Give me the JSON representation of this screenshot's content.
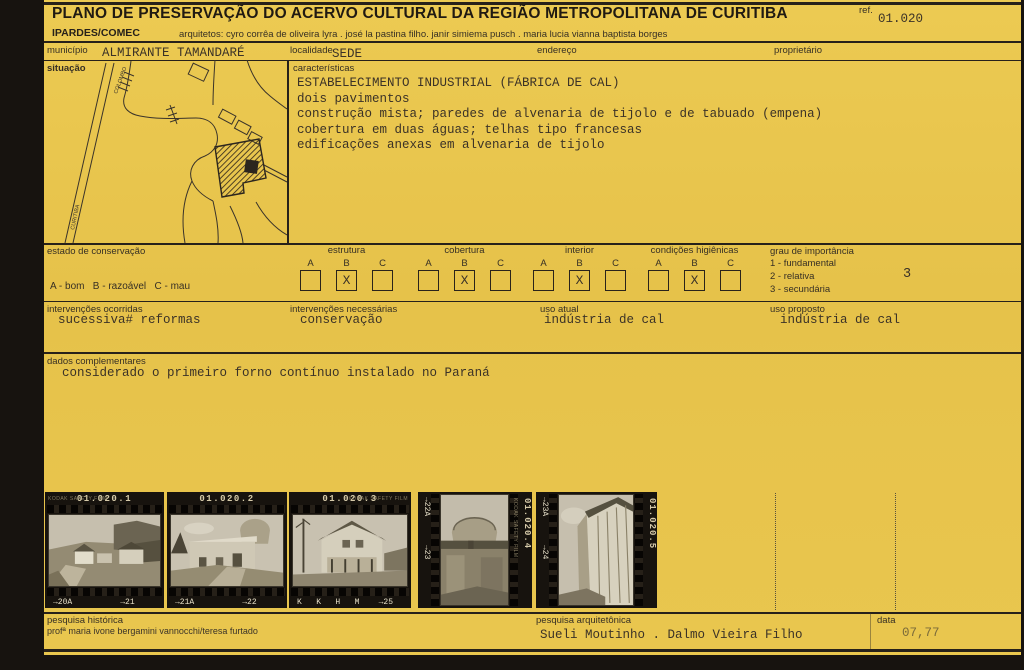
{
  "header": {
    "title": "PLANO DE PRESERVAÇÃO DO ACERVO CULTURAL DA REGIÃO METROPOLITANA DE CURITIBA",
    "org": "IPARDES/COMEC",
    "architects": "arquitetos: cyro corrêa de oliveira lyra . josé la pastina filho. janir simiema pusch . maria lucia vianna baptista borges",
    "ref_label": "ref.",
    "ref_value": "01.020"
  },
  "fields": {
    "municipio": {
      "label": "município",
      "value": "ALMIRANTE TAMANDARÉ"
    },
    "localidade": {
      "label": "localidade",
      "value": "SEDE"
    },
    "endereco": {
      "label": "endereço",
      "value": ""
    },
    "proprietario": {
      "label": "proprietário",
      "value": ""
    }
  },
  "situacao": {
    "label": "situação",
    "map_labels": {
      "road_top": "COLOMBO",
      "road_left": "CURITIBA"
    }
  },
  "caracteristicas": {
    "label": "características",
    "lines": [
      "ESTABELECIMENTO INDUSTRIAL (FÁBRICA DE CAL)",
      "dois pavimentos",
      "construção mista; paredes de alvenaria de tijolo e de tabuado (empena)",
      "cobertura em duas águas; telhas tipo francesas",
      "edificações anexas em alvenaria de tijolo"
    ]
  },
  "conservacao": {
    "label": "estado de conservação",
    "legend": "A - bom   B - razoável   C - mau",
    "letters": [
      "A",
      "B",
      "C"
    ],
    "mark": "X",
    "groups": [
      {
        "name": "estrutura",
        "checked": "B"
      },
      {
        "name": "cobertura",
        "checked": "B"
      },
      {
        "name": "interior",
        "checked": "B"
      },
      {
        "name": "condições higiênicas",
        "checked": "B"
      }
    ]
  },
  "importancia": {
    "label": "grau de importância",
    "options": [
      "1 - fundamental",
      "2 - relativa",
      "3 - secundária"
    ],
    "value": "3"
  },
  "intervencoes": {
    "ocorridas": {
      "label": "intervenções ocorridas",
      "value": "sucessiva# reformas"
    },
    "necessarias": {
      "label": "intervenções necessárias",
      "value": "conservação"
    },
    "uso_atual": {
      "label": "uso atual",
      "value": "indústria de cal"
    },
    "uso_proposto": {
      "label": "uso proposto",
      "value": "indústria de cal"
    }
  },
  "dados_complementares": {
    "label": "dados complementares",
    "value": "considerado o primeiro forno contínuo instalado no Paraná"
  },
  "photos": {
    "strips": [
      {
        "id": "01.020.1",
        "brand": "KODAK SAFETY FILM",
        "frames": "→20A          →21",
        "orientation": "landscape"
      },
      {
        "id": "01.020.2",
        "brand": "",
        "frames": "→21A          →22",
        "orientation": "landscape"
      },
      {
        "id": "01.020.3",
        "brand": "KODAK SAFETY FILM",
        "frames": "K   K   H   M    →25",
        "orientation": "landscape"
      },
      {
        "id": "01.020.4",
        "brand": "KODAK SAFETY FILM",
        "frames": "→22A      →23",
        "orientation": "portrait"
      },
      {
        "id": "01.020.5",
        "brand": "",
        "frames": "→23A      →24",
        "orientation": "portrait"
      }
    ]
  },
  "footer": {
    "pesquisa_historica": {
      "label": "pesquisa histórica",
      "value": "profª maria ivone bergamini vannocchi/teresa furtado"
    },
    "pesquisa_arquitetonica": {
      "label": "pesquisa arquitetônica",
      "value": "Sueli Moutinho . Dalmo Vieira Filho"
    },
    "data": {
      "label": "data",
      "value": "07,77"
    }
  },
  "colors": {
    "card": "#e6c24a",
    "ink": "#27211a",
    "film": "#17130e"
  }
}
